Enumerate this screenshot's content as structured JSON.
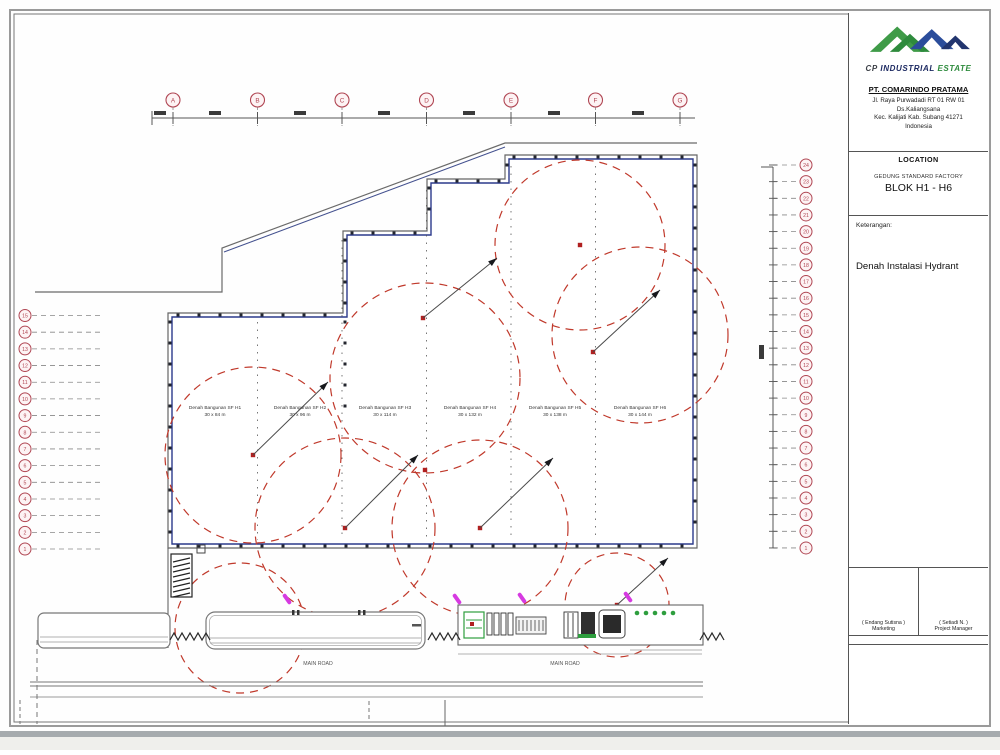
{
  "title_block": {
    "logo": {
      "cp": "CP",
      "industrial": "INDUSTRIAL",
      "estate": "ESTATE"
    },
    "company": {
      "name": "PT. COMARINDO PRATAMA",
      "address_lines": [
        "Jl. Raya Purwadadi RT 01 RW 01",
        "Ds.Kaliangsana",
        "Kec. Kalijati Kab. Subang 41271",
        "Indonesia"
      ]
    },
    "location": {
      "header": "LOCATION",
      "building": "GEDUNG STANDARD FACTORY",
      "block": "BLOK H1 - H6"
    },
    "notes": {
      "label": "Keterangan:",
      "drawing_title": "Denah Instalasi Hydrant"
    },
    "signatures": [
      {
        "name": "( Endang Sutisna )",
        "role": "Marketing"
      },
      {
        "name": "( Setiadi N. )",
        "role": "Project Manager"
      }
    ]
  },
  "grids": {
    "top": [
      "A",
      "B",
      "C",
      "D",
      "E",
      "F",
      "G"
    ],
    "left": [
      "15",
      "14",
      "13",
      "12",
      "11",
      "10",
      "9",
      "8",
      "7",
      "6",
      "5",
      "4",
      "3",
      "2",
      "1"
    ],
    "right": [
      "24",
      "23",
      "22",
      "21",
      "20",
      "19",
      "18",
      "17",
      "16",
      "15",
      "14",
      "13",
      "12",
      "11",
      "10",
      "9",
      "8",
      "7",
      "6",
      "5",
      "4",
      "3",
      "2",
      "1"
    ]
  },
  "buildings": [
    {
      "label": "Denah Bangunan SF H1",
      "size": "30 x 84 m"
    },
    {
      "label": "Denah Bangunan SF H2",
      "size": "30 x 96 m"
    },
    {
      "label": "Denah Bangunan SF H3",
      "size": "30 x 114 m"
    },
    {
      "label": "Denah Bangunan SF H4",
      "size": "30 x 132 m"
    },
    {
      "label": "Denah Bangunan SF H5",
      "size": "30 x 138 m"
    },
    {
      "label": "Denah Bangunan SF H6",
      "size": "30 x 144 m"
    }
  ],
  "roads": {
    "left_label": "MAIN ROAD",
    "right_label": "MAIN ROAD"
  },
  "colors": {
    "bubble": "#b04653",
    "hydrant_circle": "#c0392b",
    "wall": "#2c3a8c",
    "outline": "#666666",
    "marker": "#d63ae1",
    "green": "#2e9e3e",
    "logo_green": "#3f9b48",
    "logo_blue": "#2b4d9b",
    "logo_navy": "#22356e"
  }
}
